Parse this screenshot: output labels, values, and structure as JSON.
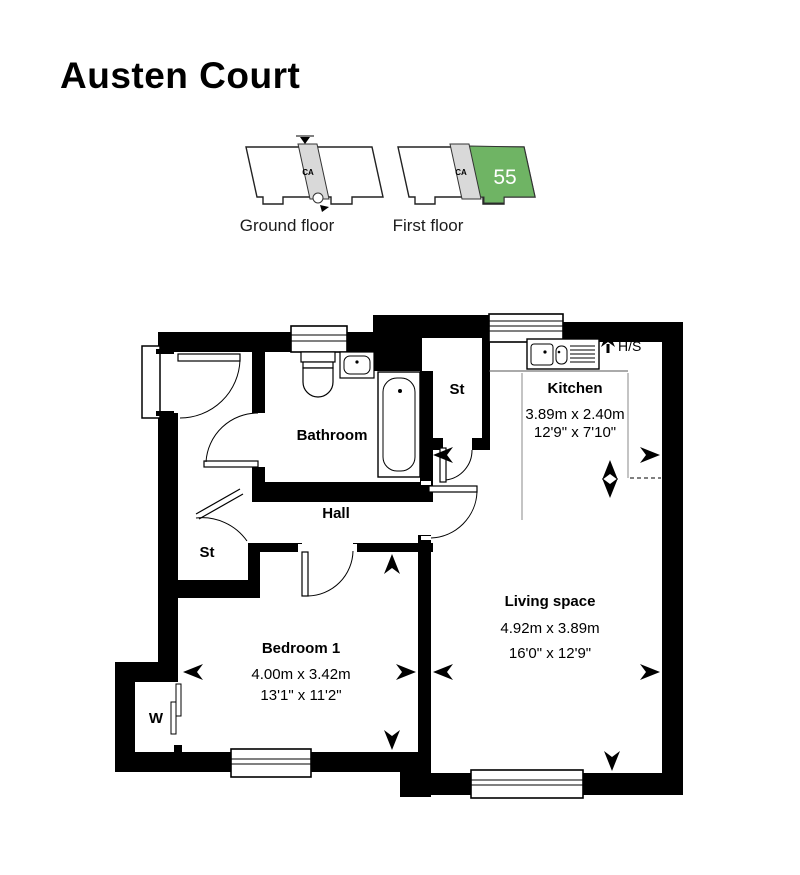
{
  "colors": {
    "title_green": "#6CBB5A",
    "unit_green": "#6FB464",
    "ca_grey": "#D9D9D9",
    "wall_black": "#000000"
  },
  "title": "Austen Court",
  "locator": {
    "ground": {
      "label": "Ground floor",
      "ca": "CA"
    },
    "first": {
      "label": "First floor",
      "ca": "CA",
      "unit": "55"
    }
  },
  "plan": {
    "bathroom": {
      "label": "Bathroom"
    },
    "hall": {
      "label": "Hall"
    },
    "storage_top": {
      "label": "St"
    },
    "storage_left": {
      "label": "St"
    },
    "wardrobe": {
      "label": "W"
    },
    "heating": {
      "label": "H/S"
    },
    "kitchen": {
      "label": "Kitchen",
      "metric": "3.89m x 2.40m",
      "imperial": "12'9\" x 7'10\""
    },
    "living": {
      "label": "Living space",
      "metric": "4.92m x 3.89m",
      "imperial": "16'0\" x 12'9\""
    },
    "bedroom": {
      "label": "Bedroom 1",
      "metric": "4.00m x 3.42m",
      "imperial": "13'1\" x 11'2\""
    }
  }
}
